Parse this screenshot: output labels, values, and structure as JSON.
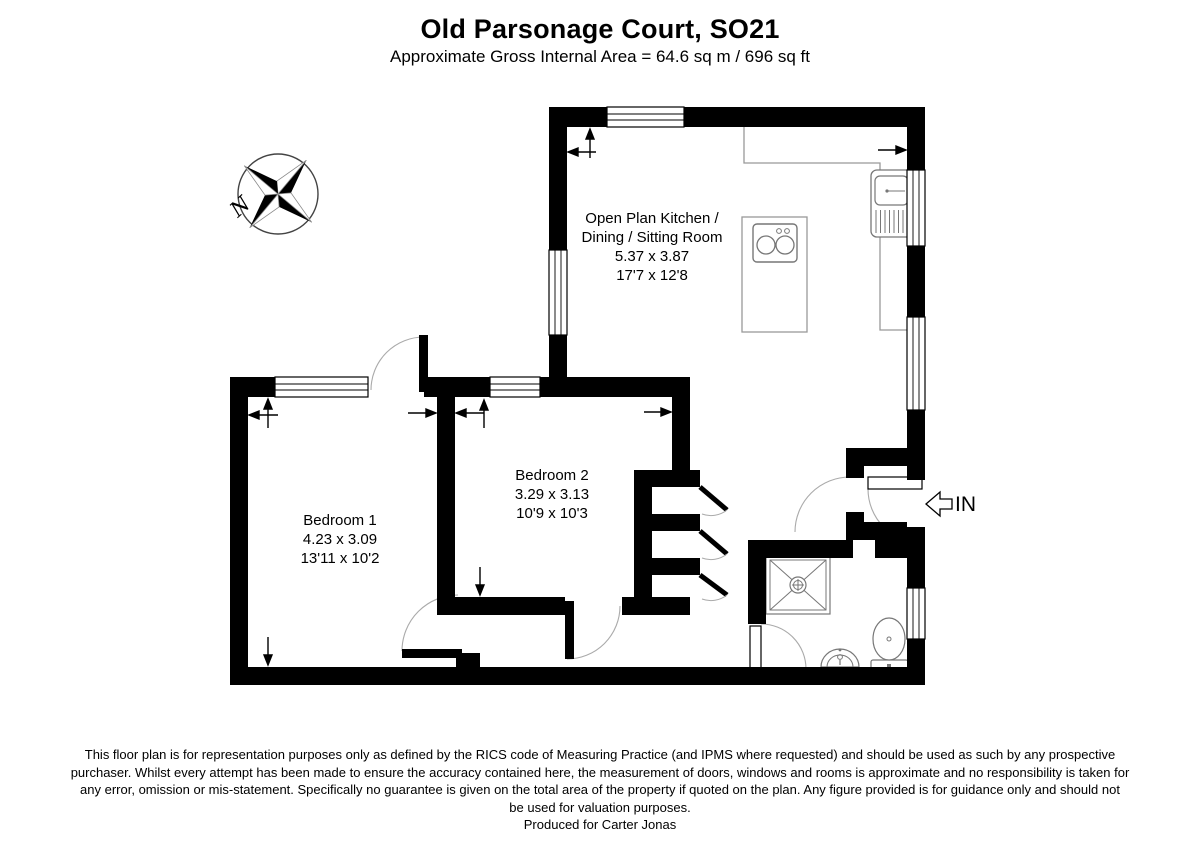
{
  "header": {
    "title": "Old Parsonage Court, SO21",
    "subtitle": "Approximate Gross Internal Area = 64.6 sq m / 696 sq ft"
  },
  "compass": {
    "n_label": "N"
  },
  "rooms": {
    "kitchen": {
      "line1": "Open Plan Kitchen /",
      "line2": "Dining / Sitting Room",
      "metric": "5.37 x 3.87",
      "imperial": "17'7 x 12'8"
    },
    "bedroom1": {
      "name": "Bedroom 1",
      "metric": "4.23 x 3.09",
      "imperial": "13'11 x 10'2"
    },
    "bedroom2": {
      "name": "Bedroom 2",
      "metric": "3.29 x 3.13",
      "imperial": "10'9 x 10'3"
    }
  },
  "entrance": {
    "in_label": "IN"
  },
  "footer": {
    "line1": "This floor plan is for representation purposes only as defined by the RICS code of Measuring Practice (and IPMS where requested) and should be used as such by any prospective",
    "line2": "purchaser. Whilst every attempt has been made to ensure the accuracy contained here, the measurement of doors, windows and rooms is approximate and no responsibility is taken for",
    "line3": "any error, omission or mis-statement. Specifically no guarantee is given on the total area of the property if quoted on the plan. Any figure provided is for guidance only and should not",
    "line4": "be used for valuation purposes.",
    "produced_for": "Produced for Carter Jonas"
  },
  "colors": {
    "wall": "#000000",
    "fixture": "#777777",
    "arc": "#aaaaaa"
  }
}
